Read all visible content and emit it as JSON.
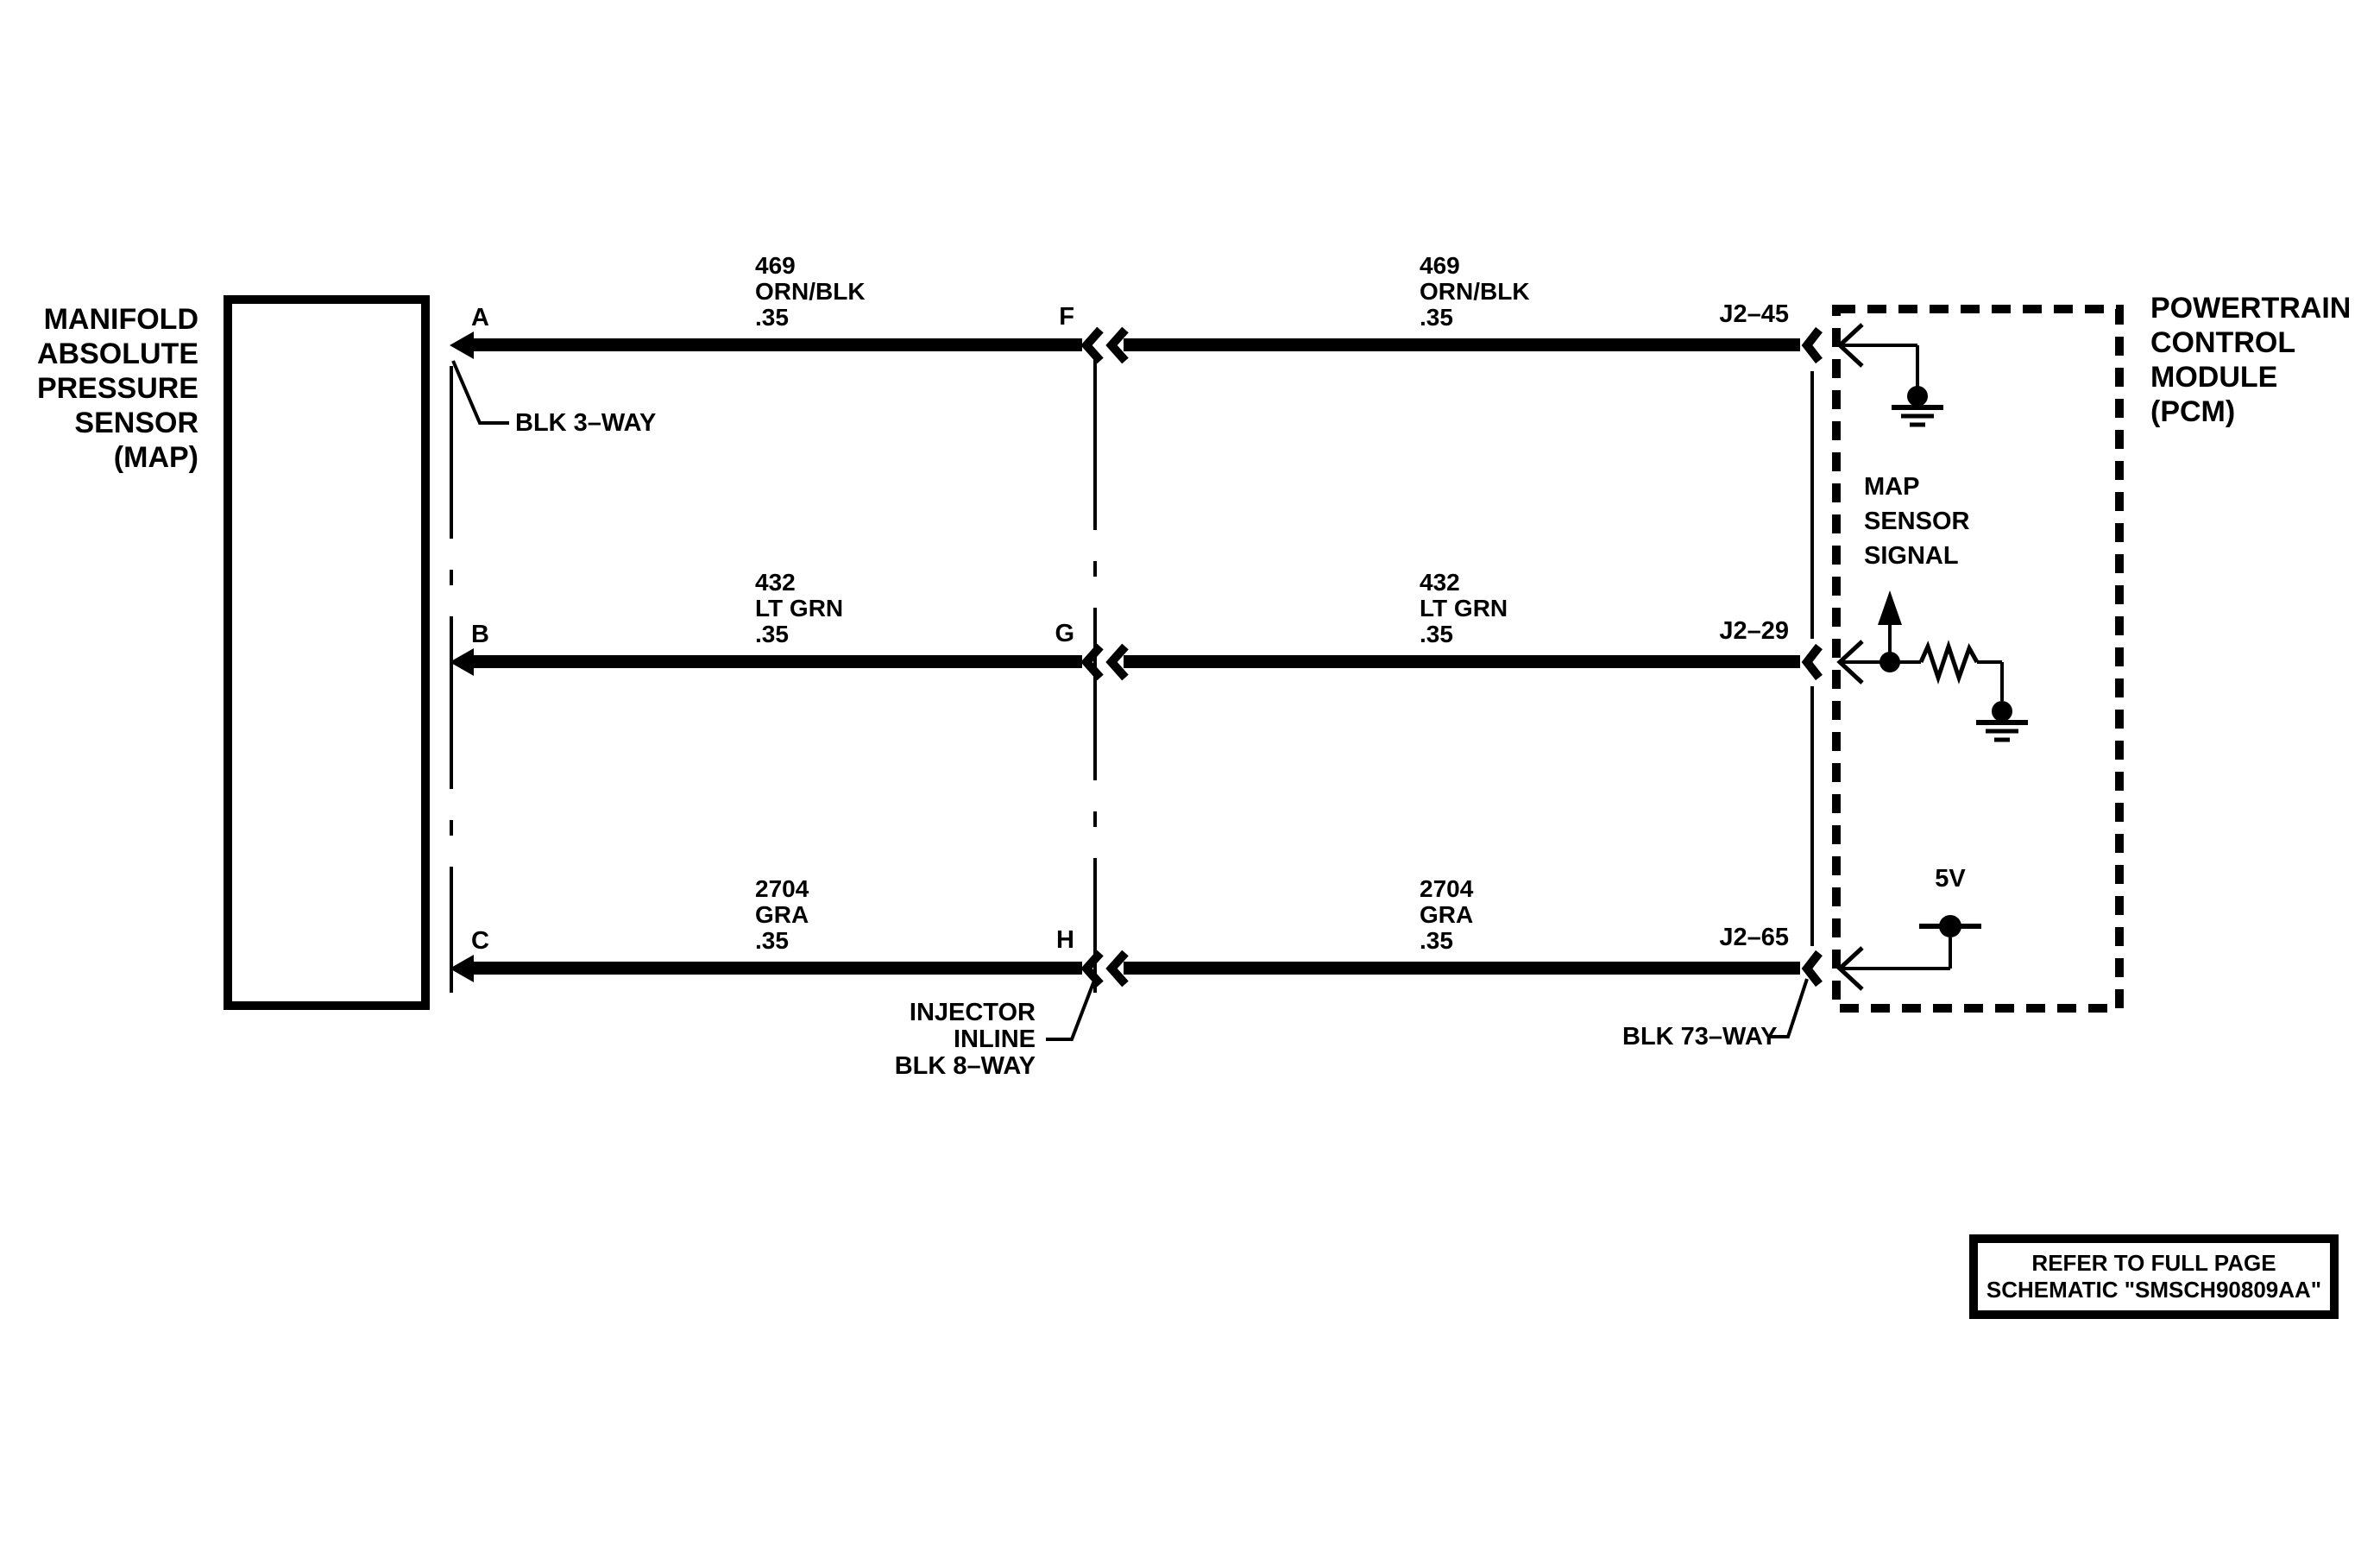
{
  "diagram_colors": {
    "line": "#000000",
    "background": "#ffffff"
  },
  "sensor": {
    "name_lines": [
      "MANIFOLD",
      "ABSOLUTE",
      "PRESSURE",
      "SENSOR",
      "(MAP)"
    ],
    "connector_label": "BLK 3–WAY"
  },
  "pcm": {
    "name_lines": [
      "POWERTRAIN",
      "CONTROL",
      "MODULE",
      "(PCM)"
    ],
    "connector_label": "BLK 73–WAY",
    "signal_lines": [
      "MAP",
      "SENSOR",
      "SIGNAL"
    ],
    "supply_label": "5V"
  },
  "inline_connector": {
    "label_lines": [
      "INJECTOR",
      "INLINE",
      "BLK 8–WAY"
    ]
  },
  "wires": [
    {
      "sensor_pin": "A",
      "inline_pin": "F",
      "pcm_pin": "J2–45",
      "circuit": "469",
      "wire_color": "ORN/BLK",
      "gauge": ".35"
    },
    {
      "sensor_pin": "B",
      "inline_pin": "G",
      "pcm_pin": "J2–29",
      "circuit": "432",
      "wire_color": "LT GRN",
      "gauge": ".35"
    },
    {
      "sensor_pin": "C",
      "inline_pin": "H",
      "pcm_pin": "J2–65",
      "circuit": "2704",
      "wire_color": "GRA",
      "gauge": ".35"
    }
  ],
  "note_lines": [
    "REFER TO FULL PAGE",
    "SCHEMATIC \"SMSCH90809AA\""
  ]
}
